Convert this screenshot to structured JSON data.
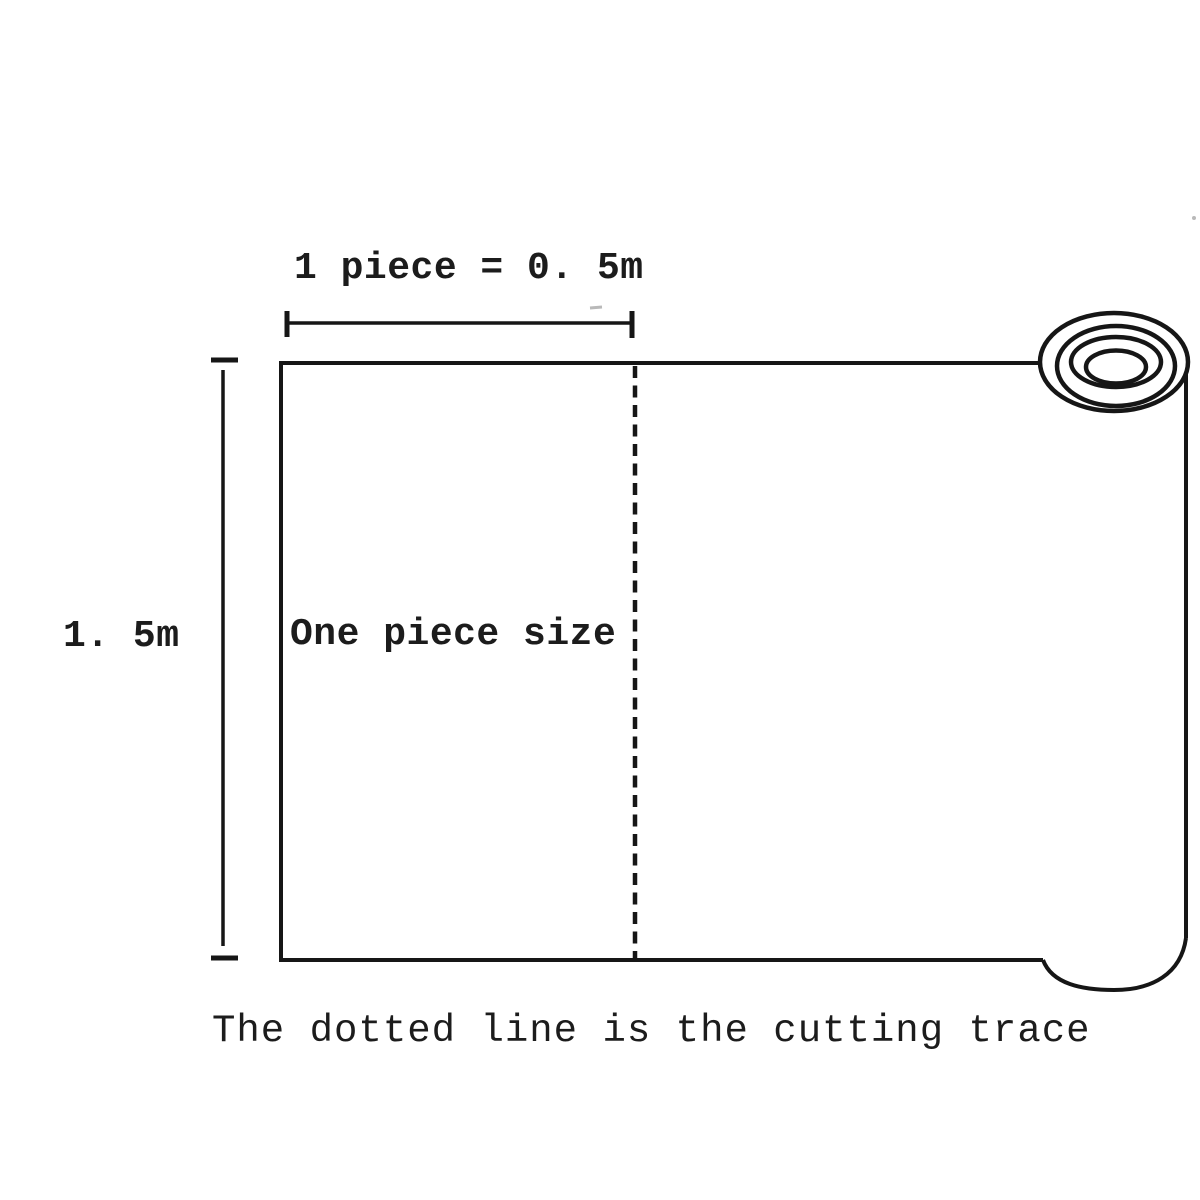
{
  "diagram": {
    "type": "product-dimension-diagram",
    "subject": "roll of material with one cut piece marked",
    "labels": {
      "top_dimension": "1 piece = 0. 5m",
      "left_dimension": "1. 5m",
      "piece": "One piece size",
      "caption": "The dotted line is the cutting trace"
    },
    "dimensions": {
      "piece_width_m": 0.5,
      "roll_height_m": 1.5
    },
    "icons": {
      "paper_roll": "concentric-ellipses-roll-end"
    },
    "colors": {
      "background": "#ffffff",
      "ink": "#161616",
      "text": "#1c1c1c",
      "artifact": "#b9b9b9"
    },
    "line_styles": {
      "cutting_line": "dashed",
      "sheet_outline": "solid"
    }
  }
}
